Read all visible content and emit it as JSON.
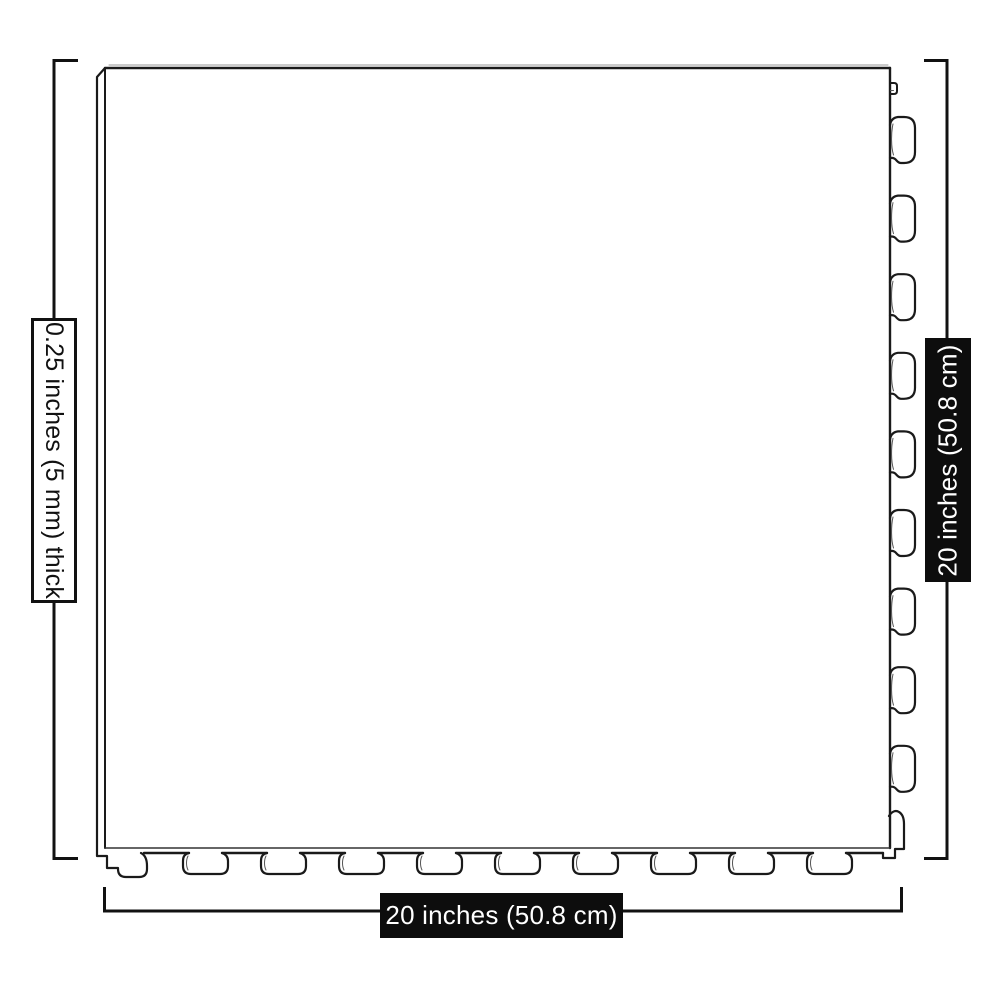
{
  "diagram": {
    "subject": "interlocking-floor-tile-top-view",
    "background_color": "#ffffff",
    "line_color": "#1a1a1a",
    "dimension_line_color": "#111111",
    "tile": {
      "right_edge_tab_count": 10,
      "bottom_edge_tab_count": 10
    },
    "dimensions": {
      "thickness": {
        "text": "0.25 inches (5 mm) thick",
        "side": "left",
        "box_style": "outlined",
        "box_bg": "#ffffff",
        "box_border": "#111111",
        "text_color": "#111111"
      },
      "height": {
        "text": "20 inches (50.8 cm)",
        "side": "right",
        "box_style": "solid",
        "box_bg": "#0d0d0d",
        "text_color": "#ffffff"
      },
      "width": {
        "text": "20 inches (50.8 cm)",
        "side": "bottom",
        "box_style": "solid",
        "box_bg": "#0d0d0d",
        "text_color": "#ffffff"
      }
    }
  }
}
